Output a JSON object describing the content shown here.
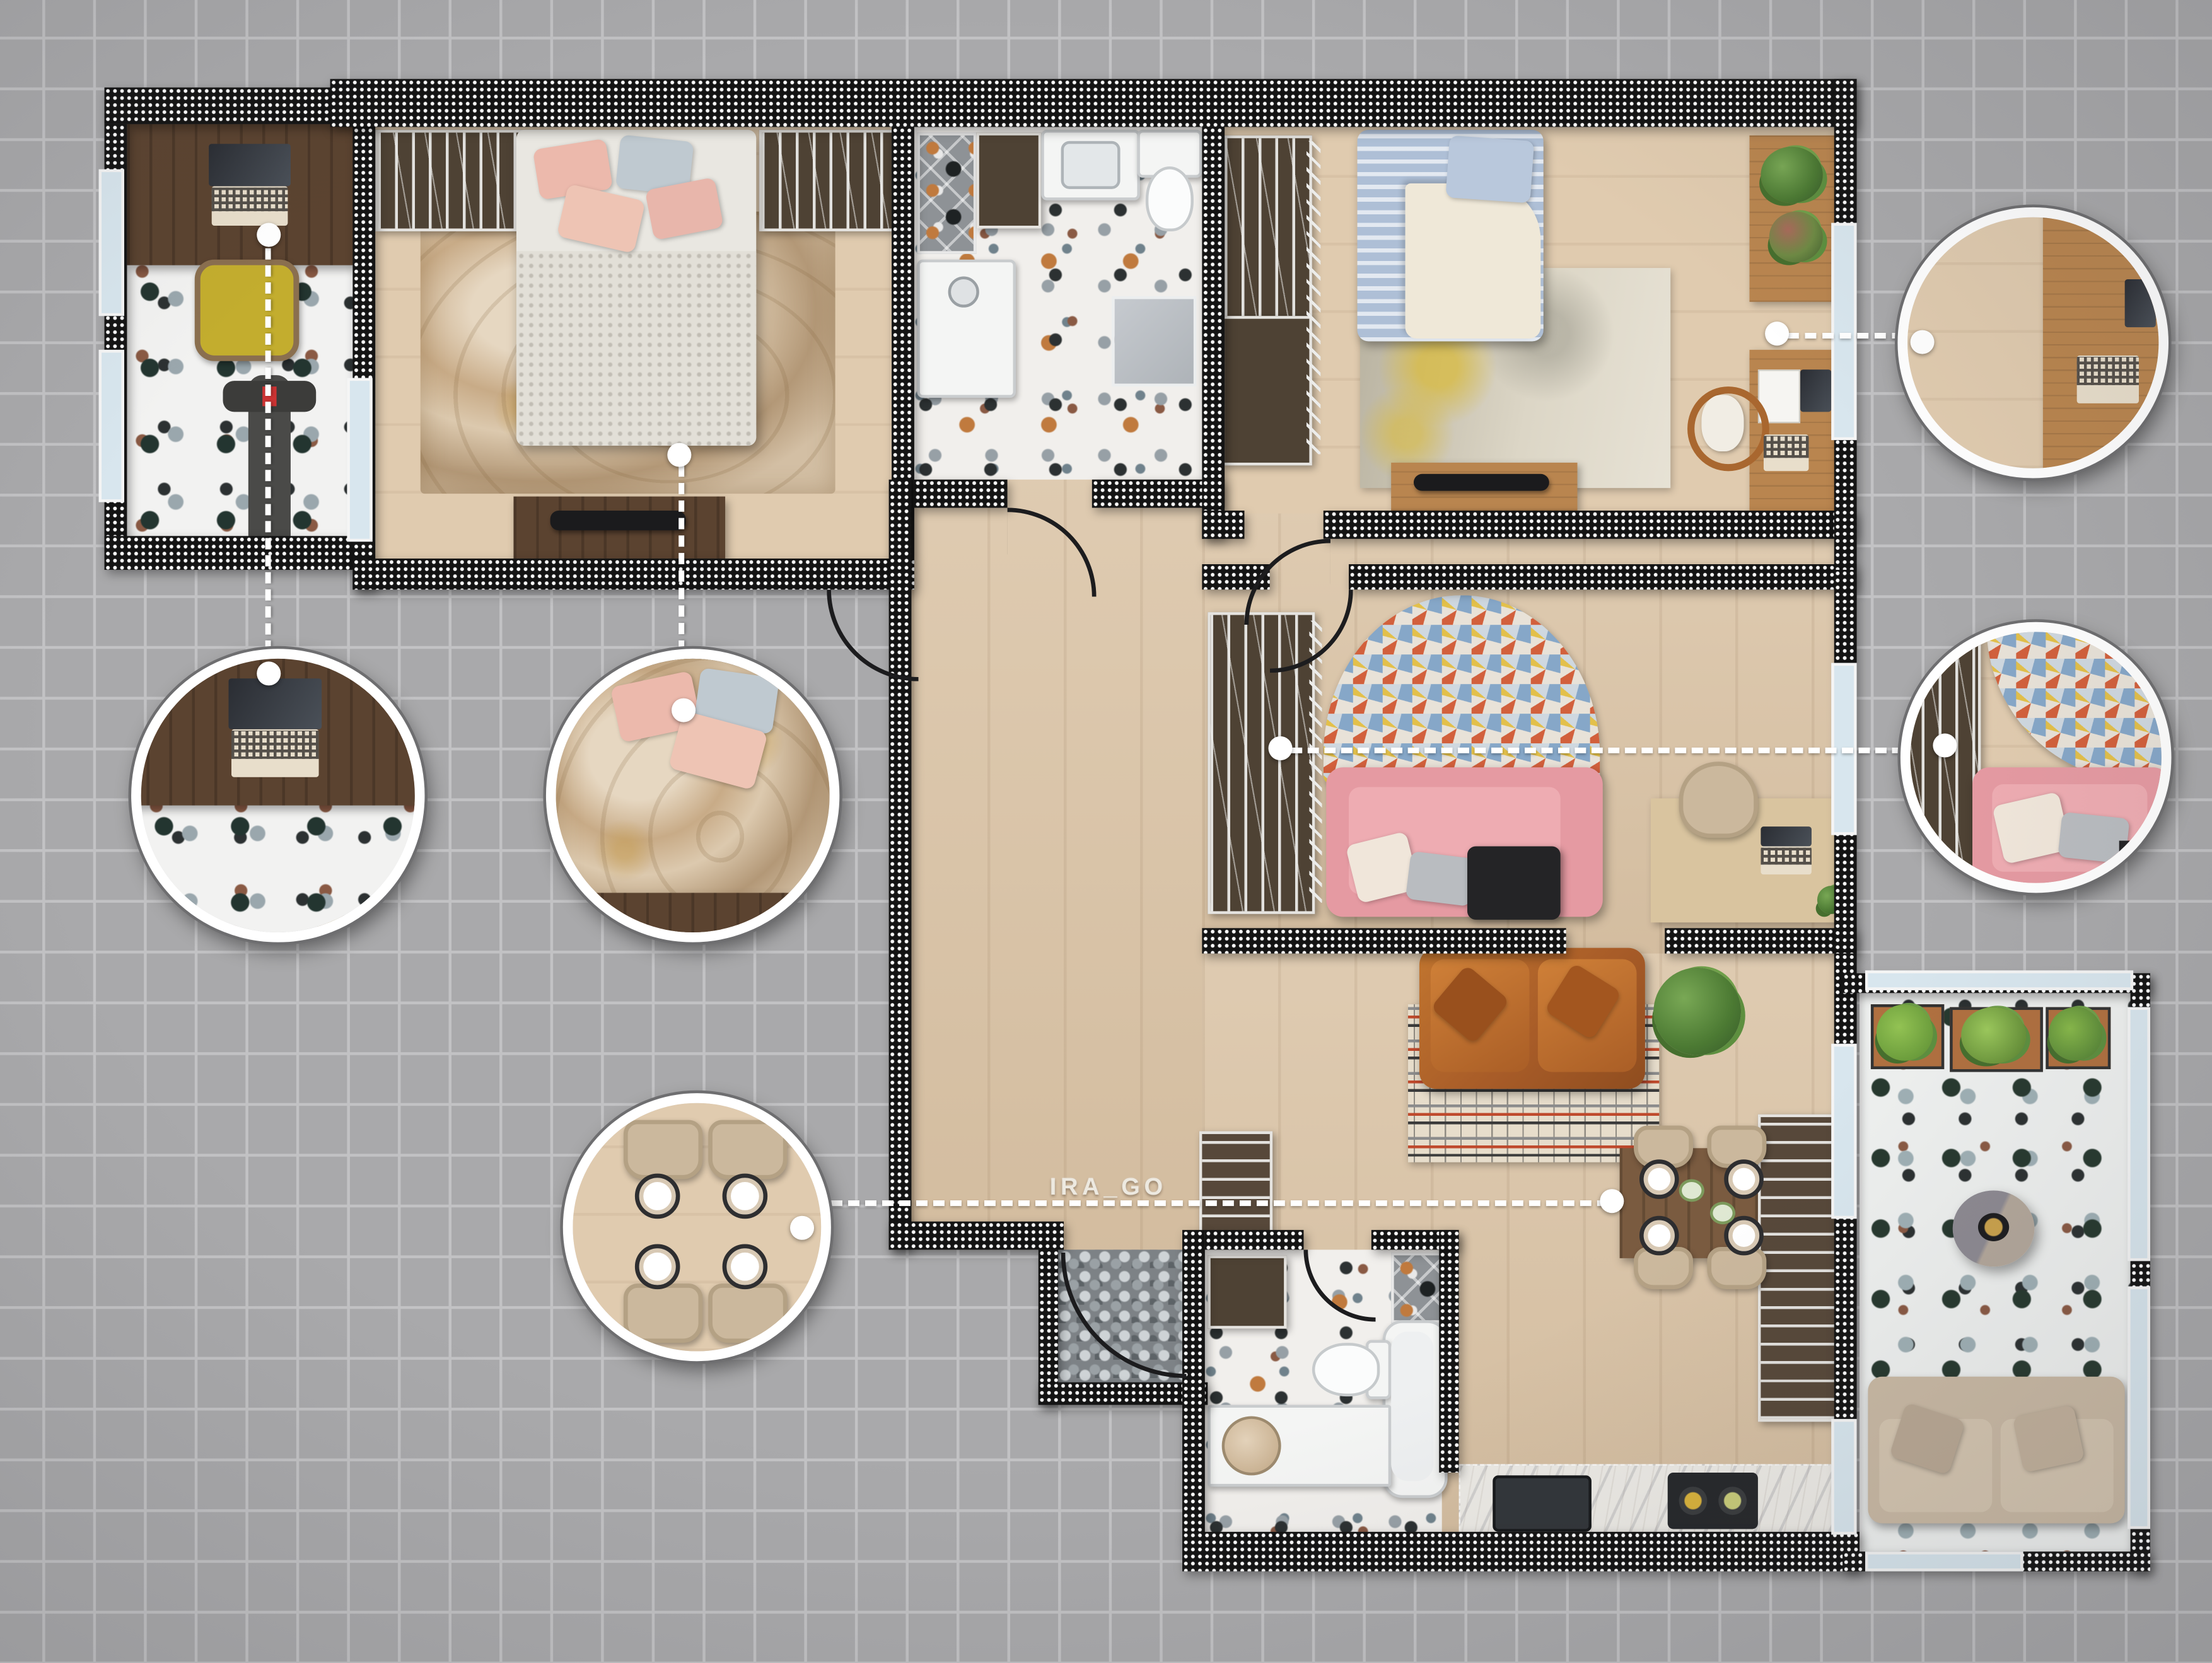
{
  "watermark": {
    "text": "IRA_GO"
  },
  "palette": {
    "grid_bg": "#a9a9ab",
    "grid_line": "#c2c2c4",
    "wall": "#141414",
    "wall_dot": "#ffffff",
    "wood_floor": "#dbc5a8",
    "terrazzo_base": "#f1efec",
    "chip_orange": "#c07a3e",
    "chip_black": "#2c3132",
    "chip_green": "#27392f",
    "walnut_desk": "#5b4330",
    "oak_furniture": "#b9854f",
    "cabinet_brown": "#4e4234",
    "yellow_chair": "#c3ad2e",
    "pink_sofa": "#e59aa2",
    "leather_sofa": "#a85c28",
    "beige_sofa": "#c9b9a4",
    "blue_bedding": "#aebfd6",
    "duvet": "#e9e7e1",
    "pillow_pink": "#ecb9ac",
    "pillow_gray": "#bfc9d0",
    "rug_marble": "#d3bfa4",
    "rug_gold": "#c59a48",
    "rug_yellow": "#d9bb3e",
    "mosaic_blue": "#86a7c8",
    "mosaic_red": "#d2603c",
    "mosaic_yellow": "#e3c04a",
    "stripe_red": "#bf4a2d",
    "marble_counter": "#eceae5",
    "pebble_mat": "#7d8286",
    "window_glass": "#d8e6ee",
    "window_frame": "#f5f5f5",
    "connector": "#ffffff",
    "callout_ring": "#ffffff",
    "callout_edge": "#6e6e70",
    "plant_green": "#4c7a33",
    "planter_terracotta": "#b07040",
    "tv_black": "#1b1b1d"
  },
  "floorplan": {
    "rooms": [
      {
        "id": "loggia-gym",
        "floor": "terrazzo",
        "furniture": [
          "walnut-desk",
          "laptop",
          "yellow-chair",
          "exercise-bike"
        ]
      },
      {
        "id": "master-bedroom",
        "floor": "wood",
        "furniture": [
          "wardrobe-left",
          "wardrobe-right",
          "double-bed",
          "marble-rug",
          "tv-dresser",
          "tv"
        ]
      },
      {
        "id": "bathroom-top",
        "floor": "terrazzo",
        "furniture": [
          "shower-niche",
          "cabinet",
          "vanity-sink",
          "toilet",
          "shower-tray",
          "bath-mat"
        ]
      },
      {
        "id": "bedroom-2",
        "floor": "wood",
        "furniture": [
          "wardrobe",
          "single-bed-blue",
          "abstract-rug",
          "sideboard",
          "plants",
          "desk",
          "white-chair",
          "laptop",
          "tv-stand",
          "tv"
        ]
      },
      {
        "id": "study",
        "floor": "wood",
        "furniture": [
          "wardrobe",
          "arch-mosaic-rug",
          "pink-sofa",
          "pillows",
          "side-table",
          "desk",
          "chair",
          "laptop",
          "plant"
        ]
      },
      {
        "id": "living-dining",
        "floor": "wood",
        "furniture": [
          "leather-sofa",
          "striped-rug",
          "large-plant",
          "dining-table",
          "four-chairs",
          "plates",
          "tall-kitchen-unit",
          "hall-cabinet"
        ]
      },
      {
        "id": "kitchen",
        "floor": "wood",
        "furniture": [
          "marble-counter",
          "sink",
          "cooktop",
          "two-pans"
        ]
      },
      {
        "id": "bathroom-bottom",
        "floor": "terrazzo",
        "furniture": [
          "cabinet",
          "toilet",
          "bathtub",
          "round-sink",
          "counter",
          "shower-niche"
        ]
      },
      {
        "id": "entry-vestibule",
        "floor": "pebble-mat",
        "furniture": [
          "entry-door"
        ]
      },
      {
        "id": "balcony-right",
        "floor": "terrazzo",
        "furniture": [
          "planter-boxes",
          "pouf-table",
          "tray",
          "outdoor-sofa"
        ]
      }
    ]
  },
  "callouts": [
    {
      "id": "callout-loggia-desk",
      "subject": "desk-laptop-yellow-chair",
      "connector": "vertical-down"
    },
    {
      "id": "callout-master-bed",
      "subject": "bed-pink-pillows-marble-rug",
      "connector": "vertical-down"
    },
    {
      "id": "callout-dining-table",
      "subject": "dining-table-four-place-settings",
      "connector": "horizontal-right"
    },
    {
      "id": "callout-bedroom2-desk",
      "subject": "desk-white-chair-laptop",
      "connector": "horizontal-left"
    },
    {
      "id": "callout-study-sofa",
      "subject": "pink-sofa-mosaic-rug-wardrobe",
      "connector": "horizontal-left"
    }
  ]
}
